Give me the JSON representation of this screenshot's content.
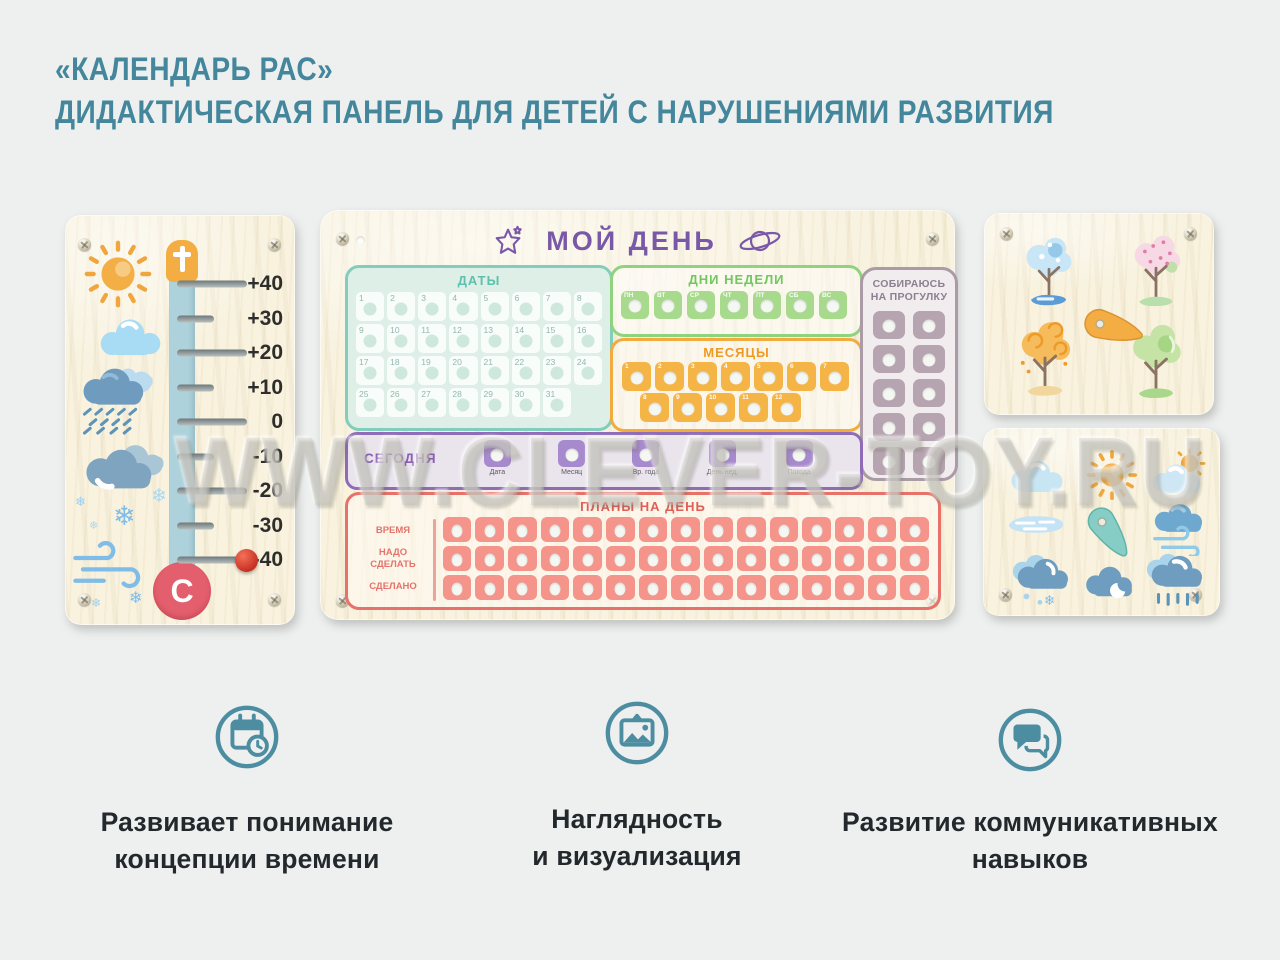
{
  "page": {
    "title_line1": "«КАЛЕНДАРЬ РАС»",
    "title_line2": "ДИДАКТИЧЕСКАЯ ПАНЕЛЬ ДЛЯ ДЕТЕЙ С НАРУШЕНИЯМИ РАЗВИТИЯ",
    "watermark": "WWW.CLEVER-TOY.RU"
  },
  "icons": {
    "snowflake": "❄"
  },
  "colors": {
    "title_teal": "#44879c",
    "feature_teal": "#4d8da1",
    "purple": "#7a58a8",
    "green": "#8fd37f",
    "mint": "#82cdbb",
    "orange": "#f2ab3e",
    "red": "#e8716a",
    "mauve": "#aa9ba6",
    "wood": "#f8f2df"
  },
  "thermometer": {
    "scale": [
      "+40",
      "+30",
      "+20",
      "+10",
      "0",
      "-10",
      "-20",
      "-30",
      "-40"
    ],
    "bulb_letter": "С",
    "weather_icons": [
      "sun",
      "cloud",
      "rain-cloud",
      "clouds",
      "snowflakes",
      "wind"
    ]
  },
  "main_panel": {
    "title": "МОЙ ДЕНЬ",
    "dates": {
      "label": "ДАТЫ",
      "cells": [
        "1",
        "2",
        "3",
        "4",
        "5",
        "6",
        "7",
        "8",
        "9",
        "10",
        "11",
        "12",
        "13",
        "14",
        "15",
        "16",
        "17",
        "18",
        "19",
        "20",
        "21",
        "22",
        "23",
        "24",
        "25",
        "26",
        "27",
        "28",
        "29",
        "30",
        "31"
      ]
    },
    "weekdays": {
      "label": "ДНИ НЕДЕЛИ",
      "tiles": [
        "ПН",
        "ВТ",
        "СР",
        "ЧТ",
        "ПТ",
        "СБ",
        "ВС"
      ]
    },
    "months": {
      "label": "МЕСЯЦЫ",
      "row1": [
        "1",
        "2",
        "3",
        "4",
        "5",
        "6",
        "7"
      ],
      "row2": [
        "8",
        "9",
        "10",
        "11",
        "12"
      ]
    },
    "walk": {
      "label": "СОБИРАЮСЬ\nНА ПРОГУЛКУ",
      "tiles": [
        "",
        "",
        "",
        "",
        "",
        "",
        "",
        "",
        "",
        ""
      ]
    },
    "today": {
      "label": "СЕГОДНЯ",
      "slots": [
        {
          "caption": "Дата"
        },
        {
          "caption": "Месяц"
        },
        {
          "caption": "Вр. года"
        },
        {
          "caption": "День нед."
        },
        {
          "caption": "Погода"
        }
      ]
    },
    "plans": {
      "label": "ПЛАНЫ НА ДЕНЬ",
      "row_labels": [
        "ВРЕМЯ",
        "НАДО\nСДЕЛАТЬ",
        "СДЕЛАНО"
      ],
      "cols": [
        "",
        "",
        "",
        "",
        "",
        "",
        "",
        "",
        "",
        "",
        "",
        "",
        "",
        "",
        ""
      ]
    }
  },
  "seasons_panel": {
    "trees": [
      "winter",
      "spring",
      "autumn",
      "summer"
    ]
  },
  "weather_panel": {
    "icons": [
      "cloud",
      "sun",
      "sun-cloud",
      "puddle",
      "wind-cloud",
      "snow-cloud",
      "moon-cloud",
      "rain-cloud"
    ]
  },
  "features": [
    {
      "icon": "calendar-clock-icon",
      "caption": "Развивает понимание\nконцепции времени"
    },
    {
      "icon": "image-icon",
      "caption": "Наглядность\nи визуализация"
    },
    {
      "icon": "chat-icon",
      "caption": "Развитие коммуникативных\nнавыков"
    }
  ]
}
